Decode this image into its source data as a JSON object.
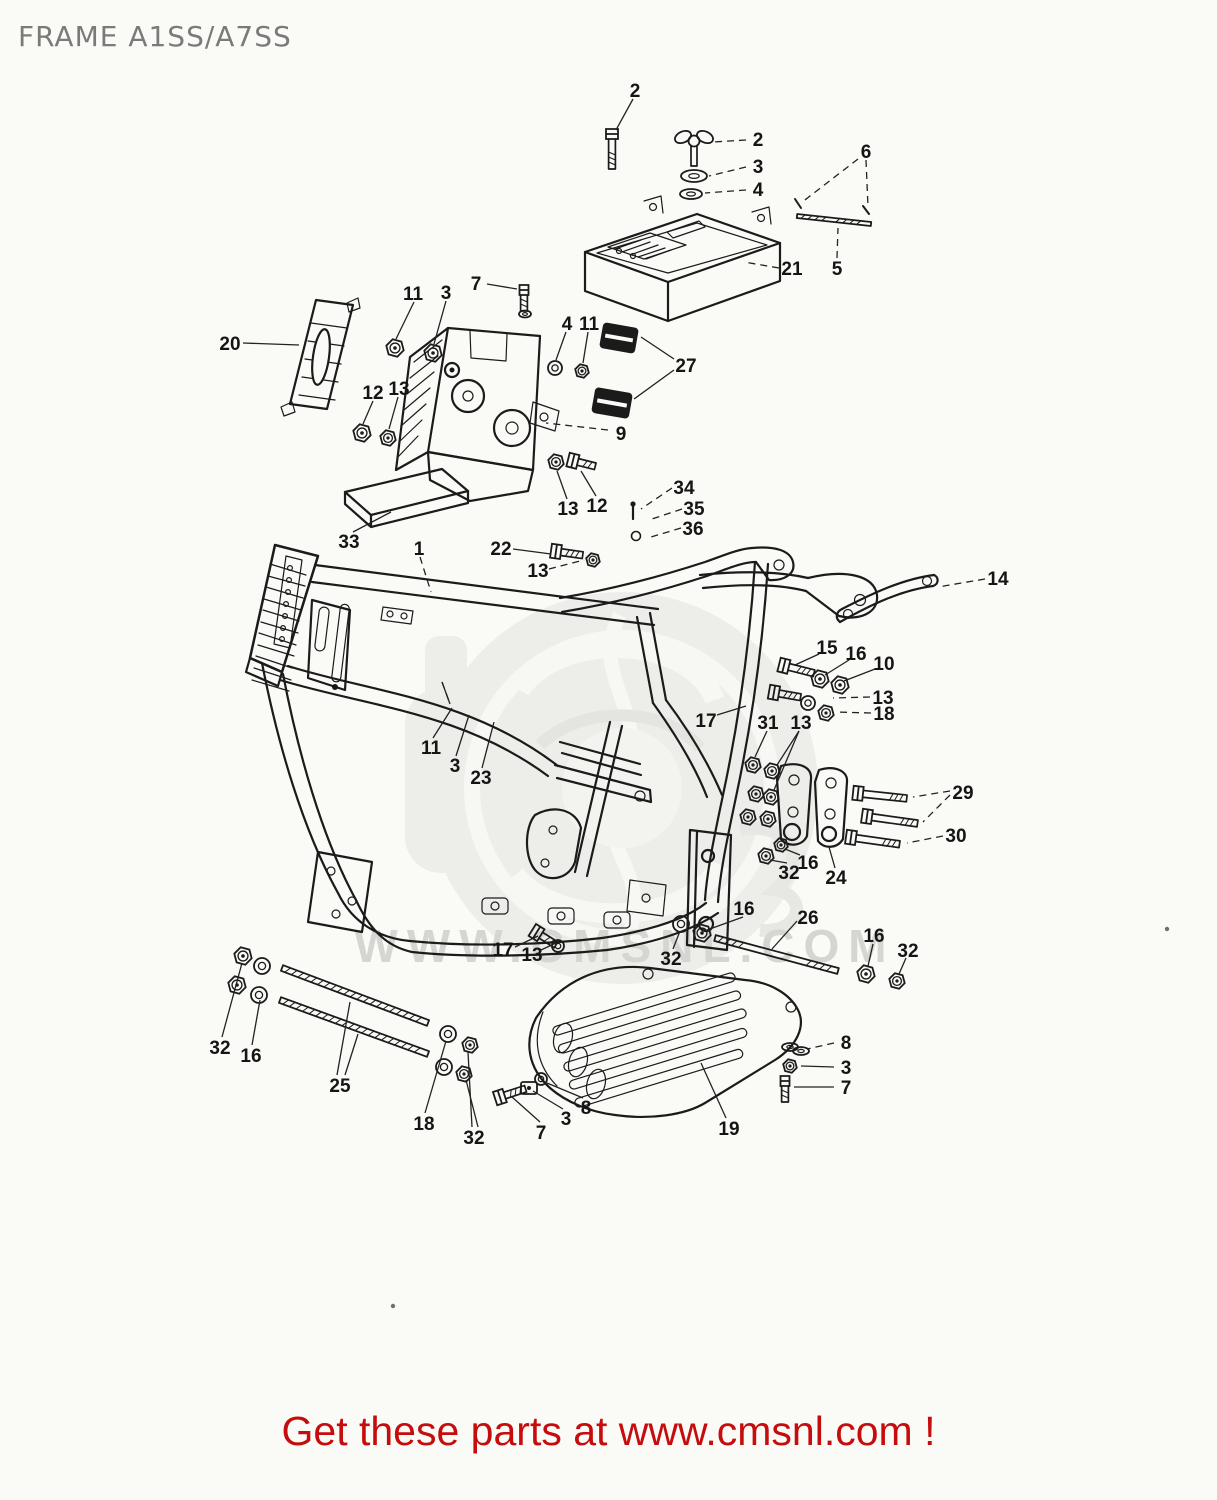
{
  "header": {
    "title": "FRAME A1SS/A7SS",
    "color": "#7a7b79"
  },
  "footer": {
    "text": "Get these parts at www.cmsnl.com !",
    "color": "#c60d0d"
  },
  "watermark": {
    "text": "WWW.CMSNL.COM",
    "color": "#d5d6d2"
  },
  "diagram": {
    "stroke": "#1b1b1b",
    "labels": [
      {
        "t": "2",
        "x": 635,
        "y": 90,
        "l": [
          [
            633,
            99,
            616,
            130
          ]
        ]
      },
      {
        "t": "2",
        "x": 758,
        "y": 139,
        "d": 1,
        "l": [
          [
            746,
            140,
            713,
            142
          ]
        ]
      },
      {
        "t": "3",
        "x": 758,
        "y": 166,
        "d": 1,
        "l": [
          [
            746,
            167,
            709,
            176
          ]
        ]
      },
      {
        "t": "4",
        "x": 758,
        "y": 189,
        "d": 1,
        "l": [
          [
            746,
            190,
            705,
            193
          ]
        ]
      },
      {
        "t": "6",
        "x": 866,
        "y": 151,
        "d": 1,
        "l": [
          [
            858,
            159,
            801,
            203
          ],
          [
            866,
            160,
            868,
            207
          ]
        ]
      },
      {
        "t": "5",
        "x": 837,
        "y": 268,
        "d": 1,
        "l": [
          [
            837,
            258,
            838,
            228
          ]
        ]
      },
      {
        "t": "21",
        "x": 792,
        "y": 268,
        "d": 1,
        "l": [
          [
            779,
            268,
            744,
            262
          ]
        ]
      },
      {
        "t": "20",
        "x": 230,
        "y": 343,
        "l": [
          [
            243,
            343,
            299,
            345
          ]
        ]
      },
      {
        "t": "11",
        "x": 413,
        "y": 293,
        "l": [
          [
            414,
            302,
            396,
            339
          ]
        ]
      },
      {
        "t": "3",
        "x": 446,
        "y": 292,
        "l": [
          [
            446,
            301,
            434,
            344
          ]
        ]
      },
      {
        "t": "7",
        "x": 476,
        "y": 283,
        "l": [
          [
            487,
            284,
            517,
            289
          ]
        ]
      },
      {
        "t": "4",
        "x": 567,
        "y": 323,
        "l": [
          [
            566,
            332,
            556,
            360
          ]
        ]
      },
      {
        "t": "11",
        "x": 589,
        "y": 323,
        "l": [
          [
            588,
            332,
            583,
            363
          ]
        ]
      },
      {
        "t": "27",
        "x": 686,
        "y": 365,
        "l": [
          [
            674,
            359,
            641,
            337
          ],
          [
            674,
            370,
            634,
            399
          ]
        ]
      },
      {
        "t": "12",
        "x": 373,
        "y": 392,
        "l": [
          [
            373,
            401,
            363,
            424
          ]
        ]
      },
      {
        "t": "13",
        "x": 399,
        "y": 388,
        "l": [
          [
            398,
            397,
            389,
            429
          ]
        ]
      },
      {
        "t": "9",
        "x": 621,
        "y": 433,
        "d": 1,
        "l": [
          [
            608,
            430,
            546,
            423
          ]
        ]
      },
      {
        "t": "13",
        "x": 568,
        "y": 508,
        "l": [
          [
            567,
            499,
            557,
            471
          ]
        ]
      },
      {
        "t": "12",
        "x": 597,
        "y": 505,
        "l": [
          [
            596,
            496,
            581,
            471
          ]
        ]
      },
      {
        "t": "33",
        "x": 349,
        "y": 541,
        "l": [
          [
            353,
            532,
            391,
            512
          ]
        ]
      },
      {
        "t": "34",
        "x": 684,
        "y": 487,
        "d": 1,
        "l": [
          [
            672,
            488,
            641,
            509
          ]
        ]
      },
      {
        "t": "35",
        "x": 694,
        "y": 508,
        "d": 1,
        "l": [
          [
            682,
            509,
            649,
            520
          ]
        ]
      },
      {
        "t": "36",
        "x": 693,
        "y": 528,
        "d": 1,
        "l": [
          [
            681,
            528,
            651,
            537
          ]
        ]
      },
      {
        "t": "1",
        "x": 419,
        "y": 548,
        "d": 1,
        "l": [
          [
            420,
            557,
            431,
            592
          ]
        ]
      },
      {
        "t": "22",
        "x": 501,
        "y": 548,
        "l": [
          [
            513,
            549,
            551,
            554
          ]
        ]
      },
      {
        "t": "13",
        "x": 538,
        "y": 570,
        "d": 1,
        "l": [
          [
            549,
            569,
            584,
            560
          ]
        ]
      },
      {
        "t": "14",
        "x": 998,
        "y": 578,
        "d": 1,
        "l": [
          [
            985,
            579,
            938,
            587
          ]
        ]
      },
      {
        "t": "15",
        "x": 827,
        "y": 647,
        "l": [
          [
            819,
            654,
            795,
            665
          ]
        ]
      },
      {
        "t": "16",
        "x": 856,
        "y": 653,
        "l": [
          [
            849,
            660,
            825,
            675
          ]
        ]
      },
      {
        "t": "10",
        "x": 884,
        "y": 663,
        "l": [
          [
            875,
            669,
            844,
            681
          ]
        ]
      },
      {
        "t": "13",
        "x": 883,
        "y": 697,
        "d": 1,
        "l": [
          [
            870,
            697,
            833,
            698
          ]
        ]
      },
      {
        "t": "18",
        "x": 884,
        "y": 713,
        "d": 1,
        "l": [
          [
            871,
            713,
            835,
            712
          ]
        ]
      },
      {
        "t": "17",
        "x": 706,
        "y": 720,
        "l": [
          [
            717,
            715,
            746,
            706
          ]
        ]
      },
      {
        "t": "31",
        "x": 768,
        "y": 722,
        "l": [
          [
            767,
            731,
            755,
            757
          ]
        ]
      },
      {
        "t": "13",
        "x": 801,
        "y": 722,
        "l": [
          [
            799,
            731,
            777,
            765
          ],
          [
            799,
            731,
            774,
            790
          ]
        ]
      },
      {
        "t": "11",
        "x": 431,
        "y": 747,
        "l": [
          [
            433,
            738,
            452,
            708
          ],
          [
            442,
            682,
            450,
            704
          ]
        ]
      },
      {
        "t": "3",
        "x": 455,
        "y": 765,
        "l": [
          [
            456,
            756,
            469,
            715
          ]
        ]
      },
      {
        "t": "23",
        "x": 481,
        "y": 777,
        "l": [
          [
            482,
            768,
            494,
            722
          ]
        ]
      },
      {
        "t": "29",
        "x": 963,
        "y": 792,
        "d": 1,
        "l": [
          [
            950,
            791,
            913,
            797
          ],
          [
            950,
            795,
            923,
            822
          ]
        ]
      },
      {
        "t": "30",
        "x": 956,
        "y": 835,
        "d": 1,
        "l": [
          [
            943,
            836,
            907,
            843
          ]
        ]
      },
      {
        "t": "32",
        "x": 789,
        "y": 872,
        "l": [
          [
            787,
            863,
            770,
            860
          ]
        ]
      },
      {
        "t": "16",
        "x": 808,
        "y": 862,
        "l": [
          [
            800,
            855,
            785,
            849
          ]
        ]
      },
      {
        "t": "24",
        "x": 836,
        "y": 877,
        "l": [
          [
            835,
            868,
            829,
            847
          ]
        ]
      },
      {
        "t": "16",
        "x": 744,
        "y": 908,
        "l": [
          [
            743,
            917,
            707,
            930
          ]
        ]
      },
      {
        "t": "26",
        "x": 808,
        "y": 917,
        "l": [
          [
            797,
            921,
            772,
            949
          ]
        ]
      },
      {
        "t": "16",
        "x": 874,
        "y": 935,
        "l": [
          [
            873,
            944,
            868,
            966
          ]
        ]
      },
      {
        "t": "32",
        "x": 908,
        "y": 950,
        "l": [
          [
            906,
            958,
            899,
            974
          ]
        ]
      },
      {
        "t": "17",
        "x": 503,
        "y": 949,
        "l": [
          [
            515,
            947,
            538,
            936
          ]
        ]
      },
      {
        "t": "13",
        "x": 532,
        "y": 954,
        "l": [
          [
            541,
            950,
            556,
            943
          ]
        ]
      },
      {
        "t": "32",
        "x": 671,
        "y": 958,
        "l": [
          [
            673,
            949,
            680,
            931
          ]
        ]
      },
      {
        "t": "19",
        "x": 729,
        "y": 1128,
        "l": [
          [
            726,
            1118,
            701,
            1063
          ]
        ]
      },
      {
        "t": "8",
        "x": 846,
        "y": 1042,
        "d": 1,
        "l": [
          [
            834,
            1043,
            807,
            1049
          ]
        ]
      },
      {
        "t": "3",
        "x": 846,
        "y": 1067,
        "l": [
          [
            834,
            1067,
            801,
            1066
          ]
        ]
      },
      {
        "t": "7",
        "x": 846,
        "y": 1087,
        "l": [
          [
            834,
            1087,
            794,
            1087
          ]
        ]
      },
      {
        "t": "32",
        "x": 220,
        "y": 1047,
        "l": [
          [
            222,
            1037,
            242,
            963
          ]
        ]
      },
      {
        "t": "16",
        "x": 251,
        "y": 1055,
        "l": [
          [
            252,
            1045,
            260,
            1000
          ]
        ]
      },
      {
        "t": "25",
        "x": 340,
        "y": 1085,
        "l": [
          [
            337,
            1075,
            350,
            1002
          ],
          [
            345,
            1075,
            358,
            1034
          ]
        ]
      },
      {
        "t": "18",
        "x": 424,
        "y": 1123,
        "l": [
          [
            425,
            1113,
            446,
            1041
          ]
        ]
      },
      {
        "t": "32",
        "x": 474,
        "y": 1137,
        "l": [
          [
            472,
            1127,
            468,
            1052
          ],
          [
            478,
            1127,
            466,
            1080
          ]
        ]
      },
      {
        "t": "7",
        "x": 541,
        "y": 1132,
        "l": [
          [
            540,
            1122,
            512,
            1097
          ]
        ]
      },
      {
        "t": "3",
        "x": 566,
        "y": 1118,
        "l": [
          [
            563,
            1109,
            533,
            1091
          ]
        ]
      },
      {
        "t": "8",
        "x": 586,
        "y": 1107,
        "l": [
          [
            583,
            1098,
            547,
            1083
          ]
        ]
      }
    ],
    "hardware": [
      {
        "k": "boltv",
        "x": 612,
        "y": 131,
        "len": 38,
        "hw": 12
      },
      {
        "k": "wing",
        "x": 694,
        "y": 140
      },
      {
        "k": "washer",
        "x": 694,
        "y": 176,
        "rx": 13,
        "ry": 6
      },
      {
        "k": "washer",
        "x": 691,
        "y": 194,
        "rx": 11,
        "ry": 5
      },
      {
        "k": "rod",
        "x1": 797,
        "y1": 216,
        "x2": 871,
        "y2": 224,
        "w": 4,
        "thread": "ends"
      },
      {
        "k": "tick",
        "x1": 795,
        "y1": 199,
        "x2": 801,
        "y2": 208
      },
      {
        "k": "tick",
        "x1": 863,
        "y1": 206,
        "x2": 869,
        "y2": 214
      },
      {
        "k": "boltv",
        "x": 524,
        "y": 287,
        "len": 24,
        "hw": 9
      },
      {
        "k": "washer",
        "x": 525,
        "y": 314,
        "rx": 6,
        "ry": 3.5
      },
      {
        "k": "nut",
        "x": 395,
        "y": 348,
        "r": 9
      },
      {
        "k": "nut",
        "x": 433,
        "y": 353,
        "r": 9
      },
      {
        "k": "nut",
        "x": 362,
        "y": 433,
        "r": 9
      },
      {
        "k": "nut",
        "x": 388,
        "y": 438,
        "r": 8
      },
      {
        "k": "cwasher",
        "x": 555,
        "y": 368,
        "r": 7
      },
      {
        "k": "nut",
        "x": 582,
        "y": 371,
        "r": 7
      },
      {
        "k": "damper",
        "x": 619,
        "y": 338,
        "w": 36,
        "h": 26,
        "a": 10
      },
      {
        "k": "damper",
        "x": 612,
        "y": 403,
        "w": 38,
        "h": 26,
        "a": 10
      },
      {
        "k": "nut",
        "x": 556,
        "y": 462,
        "r": 8
      },
      {
        "k": "bolt",
        "x": 570,
        "y": 460,
        "len": 26,
        "a": 14
      },
      {
        "k": "pin",
        "x": 633,
        "y": 506,
        "len": 13
      },
      {
        "k": "ring",
        "x": 636,
        "y": 536,
        "r": 4.5
      },
      {
        "k": "bolt",
        "x": 553,
        "y": 551,
        "len": 30,
        "a": 8
      },
      {
        "k": "nut",
        "x": 593,
        "y": 560,
        "r": 7
      },
      {
        "k": "bolt",
        "x": 781,
        "y": 665,
        "len": 34,
        "a": 14
      },
      {
        "k": "nut",
        "x": 820,
        "y": 679,
        "r": 9
      },
      {
        "k": "nut",
        "x": 840,
        "y": 685,
        "r": 9
      },
      {
        "k": "bolt",
        "x": 771,
        "y": 692,
        "len": 30,
        "a": 10
      },
      {
        "k": "cwasher",
        "x": 808,
        "y": 703,
        "r": 7
      },
      {
        "k": "nut",
        "x": 826,
        "y": 713,
        "r": 8
      },
      {
        "k": "nut",
        "x": 753,
        "y": 765,
        "r": 8
      },
      {
        "k": "nut",
        "x": 772,
        "y": 771,
        "r": 8
      },
      {
        "k": "nut",
        "x": 756,
        "y": 794,
        "r": 8
      },
      {
        "k": "nut",
        "x": 771,
        "y": 797,
        "r": 8
      },
      {
        "k": "nut",
        "x": 748,
        "y": 817,
        "r": 8
      },
      {
        "k": "nut",
        "x": 768,
        "y": 819,
        "r": 8
      },
      {
        "k": "nut",
        "x": 766,
        "y": 856,
        "r": 8
      },
      {
        "k": "nut",
        "x": 781,
        "y": 845,
        "r": 7
      },
      {
        "k": "bolt",
        "x": 855,
        "y": 793,
        "len": 52,
        "a": 6
      },
      {
        "k": "bolt",
        "x": 864,
        "y": 816,
        "len": 54,
        "a": 8
      },
      {
        "k": "bolt",
        "x": 848,
        "y": 837,
        "len": 52,
        "a": 8
      },
      {
        "k": "cwasher",
        "x": 681,
        "y": 924,
        "r": 8
      },
      {
        "k": "nut",
        "x": 702,
        "y": 933,
        "r": 9
      },
      {
        "k": "rod",
        "x1": 715,
        "y1": 938,
        "x2": 838,
        "y2": 971,
        "w": 6,
        "thread": "ends"
      },
      {
        "k": "nut",
        "x": 866,
        "y": 974,
        "r": 9
      },
      {
        "k": "nut",
        "x": 897,
        "y": 981,
        "r": 8
      },
      {
        "k": "bolt",
        "x": 534,
        "y": 931,
        "len": 26,
        "a": 32
      },
      {
        "k": "cwasher",
        "x": 558,
        "y": 946,
        "r": 6
      },
      {
        "k": "rod",
        "x1": 282,
        "y1": 968,
        "x2": 428,
        "y2": 1023,
        "w": 6,
        "thread": "full"
      },
      {
        "k": "rod",
        "x1": 280,
        "y1": 1000,
        "x2": 428,
        "y2": 1054,
        "w": 6,
        "thread": "full"
      },
      {
        "k": "nut",
        "x": 243,
        "y": 956,
        "r": 9
      },
      {
        "k": "cwasher",
        "x": 262,
        "y": 966,
        "r": 8
      },
      {
        "k": "nut",
        "x": 237,
        "y": 985,
        "r": 9
      },
      {
        "k": "cwasher",
        "x": 259,
        "y": 995,
        "r": 8
      },
      {
        "k": "cwasher",
        "x": 448,
        "y": 1034,
        "r": 8
      },
      {
        "k": "nut",
        "x": 470,
        "y": 1045,
        "r": 8
      },
      {
        "k": "cwasher",
        "x": 444,
        "y": 1067,
        "r": 8
      },
      {
        "k": "nut",
        "x": 464,
        "y": 1074,
        "r": 8
      },
      {
        "k": "bolt",
        "x": 497,
        "y": 1098,
        "len": 30,
        "a": -18
      },
      {
        "k": "sqnut",
        "x": 529,
        "y": 1088
      },
      {
        "k": "cwasher",
        "x": 541,
        "y": 1079,
        "r": 6
      },
      {
        "k": "washer",
        "x": 790,
        "y": 1047,
        "rx": 8,
        "ry": 4
      },
      {
        "k": "washer",
        "x": 801,
        "y": 1051,
        "rx": 8,
        "ry": 4
      },
      {
        "k": "nut",
        "x": 790,
        "y": 1066,
        "r": 7
      },
      {
        "k": "boltv",
        "x": 785,
        "y": 1078,
        "len": 24,
        "hw": 9
      }
    ],
    "dots": [
      [
        1167,
        929
      ],
      [
        393,
        1306
      ]
    ]
  }
}
